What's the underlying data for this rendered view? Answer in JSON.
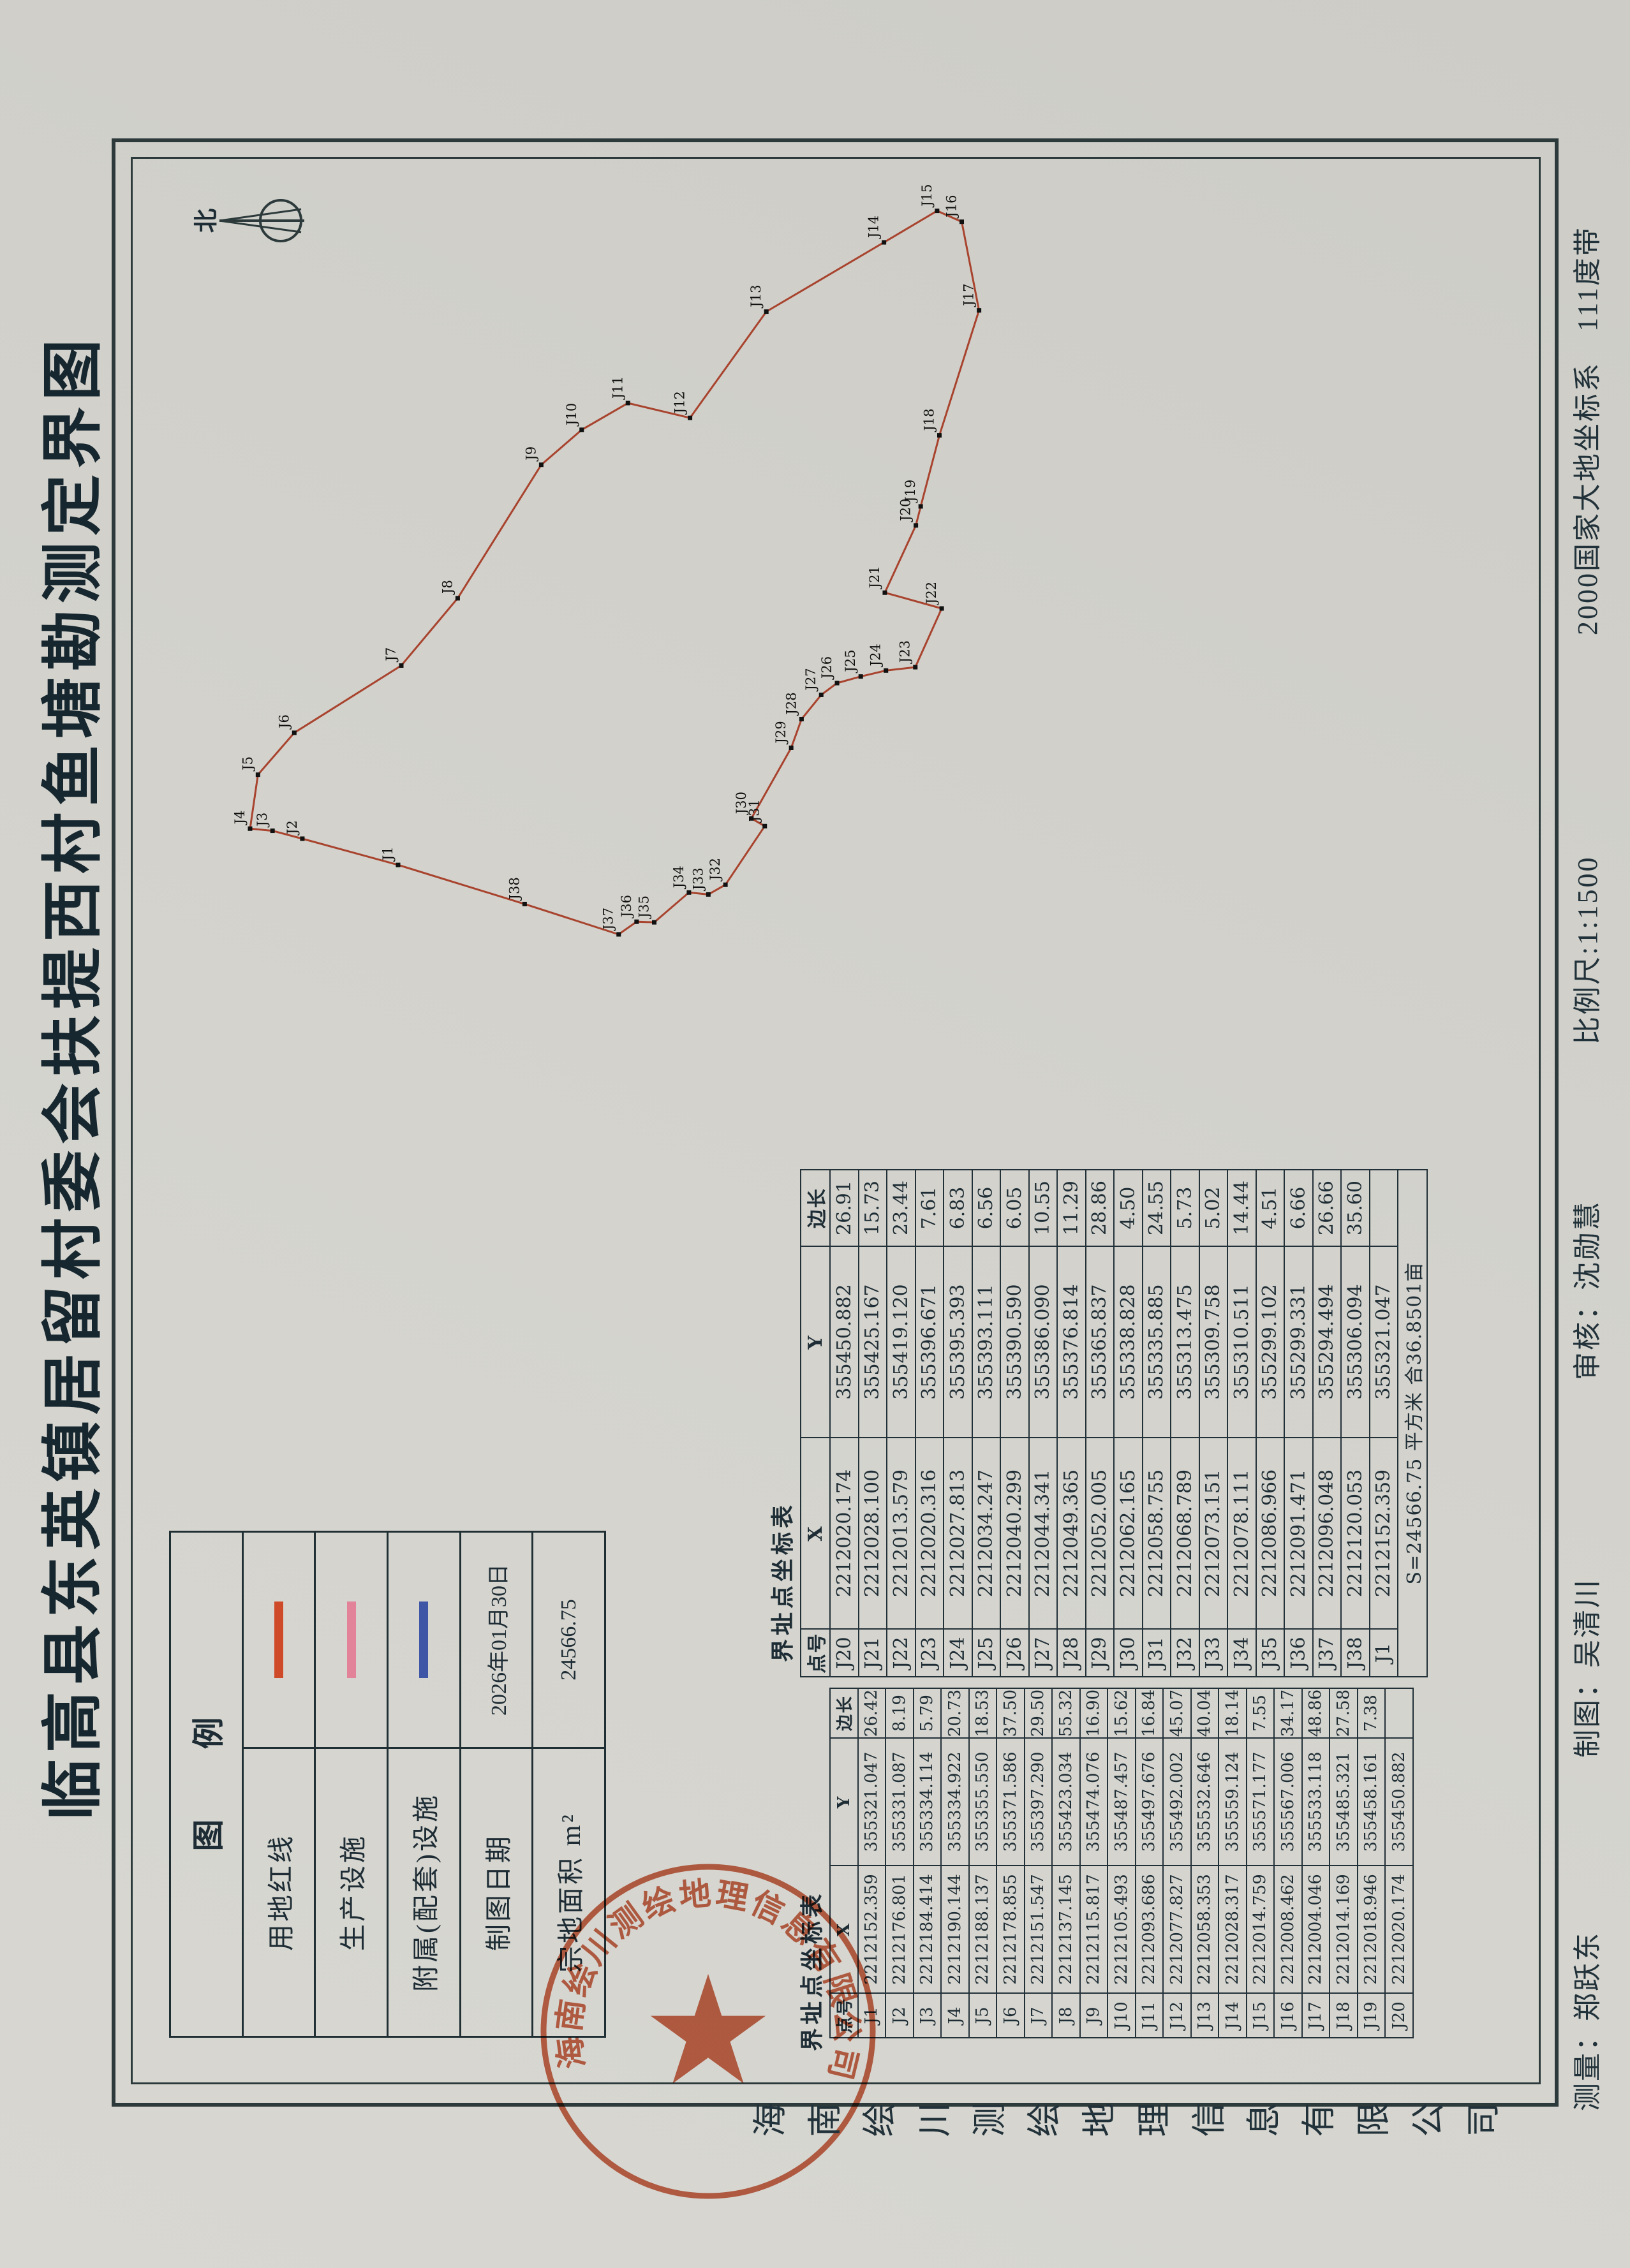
{
  "title": "临高县东英镇居留村委会扶提西村鱼塘勘测定界图",
  "compass": {
    "north": "北"
  },
  "legend": {
    "header": "图例",
    "rows": [
      {
        "label": "用地红线",
        "type": "line",
        "color": "#cf4a28",
        "value": ""
      },
      {
        "label": "生产设施",
        "type": "line",
        "color": "#e2839a",
        "value": ""
      },
      {
        "label": "附属(配套)设施",
        "type": "line",
        "color": "#3f55a6",
        "value": ""
      },
      {
        "label": "制图日期",
        "type": "text",
        "color": "",
        "value": "2026年01月30日"
      },
      {
        "label": "宗地面积 m²",
        "type": "text",
        "color": "",
        "value": "24566.75"
      }
    ]
  },
  "tables": {
    "title": "界址点坐标表",
    "columns": [
      "点号",
      "X",
      "Y",
      "边长"
    ],
    "t1": [
      [
        "J1",
        "2212152.359",
        "355321.047",
        "26.42"
      ],
      [
        "J2",
        "2212176.801",
        "355331.087",
        "8.19"
      ],
      [
        "J3",
        "2212184.414",
        "355334.114",
        "5.79"
      ],
      [
        "J4",
        "2212190.144",
        "355334.922",
        "20.73"
      ],
      [
        "J5",
        "2212188.137",
        "355355.550",
        "18.53"
      ],
      [
        "J6",
        "2212178.855",
        "355371.586",
        "37.50"
      ],
      [
        "J7",
        "2212151.547",
        "355397.290",
        "29.50"
      ],
      [
        "J8",
        "2212137.145",
        "355423.034",
        "55.32"
      ],
      [
        "J9",
        "2212115.817",
        "355474.076",
        "16.90"
      ],
      [
        "J10",
        "2212105.493",
        "355487.457",
        "15.62"
      ],
      [
        "J11",
        "2212093.686",
        "355497.676",
        "16.84"
      ],
      [
        "J12",
        "2212077.827",
        "355492.002",
        "45.07"
      ],
      [
        "J13",
        "2212058.353",
        "355532.646",
        "40.04"
      ],
      [
        "J14",
        "2212028.317",
        "355559.124",
        "18.14"
      ],
      [
        "J15",
        "2212014.759",
        "355571.177",
        "7.55"
      ],
      [
        "J16",
        "2212008.462",
        "355567.006",
        "34.17"
      ],
      [
        "J17",
        "2212004.046",
        "355533.118",
        "48.86"
      ],
      [
        "J18",
        "2212014.169",
        "355485.321",
        "27.58"
      ],
      [
        "J19",
        "2212018.946",
        "355458.161",
        "7.38"
      ],
      [
        "J20",
        "2212020.174",
        "355450.882",
        ""
      ]
    ],
    "t2": [
      [
        "J20",
        "2212020.174",
        "355450.882",
        "26.91"
      ],
      [
        "J21",
        "2212028.100",
        "355425.167",
        "15.73"
      ],
      [
        "J22",
        "2212013.579",
        "355419.120",
        "23.44"
      ],
      [
        "J23",
        "2212020.316",
        "355396.671",
        "7.61"
      ],
      [
        "J24",
        "2212027.813",
        "355395.393",
        "6.83"
      ],
      [
        "J25",
        "2212034.247",
        "355393.111",
        "6.56"
      ],
      [
        "J26",
        "2212040.299",
        "355390.590",
        "6.05"
      ],
      [
        "J27",
        "2212044.341",
        "355386.090",
        "10.55"
      ],
      [
        "J28",
        "2212049.365",
        "355376.814",
        "11.29"
      ],
      [
        "J29",
        "2212052.005",
        "355365.837",
        "28.86"
      ],
      [
        "J30",
        "2212062.165",
        "355338.828",
        "4.50"
      ],
      [
        "J31",
        "2212058.755",
        "355335.885",
        "24.55"
      ],
      [
        "J32",
        "2212068.789",
        "355313.475",
        "5.73"
      ],
      [
        "J33",
        "2212073.151",
        "355309.758",
        "5.02"
      ],
      [
        "J34",
        "2212078.111",
        "355310.511",
        "14.44"
      ],
      [
        "J35",
        "2212086.966",
        "355299.102",
        "4.51"
      ],
      [
        "J36",
        "2212091.471",
        "355299.331",
        "6.66"
      ],
      [
        "J37",
        "2212096.048",
        "355294.494",
        "26.66"
      ],
      [
        "J38",
        "2212120.053",
        "355306.094",
        "35.60"
      ],
      [
        "J1",
        "2212152.359",
        "355321.047",
        ""
      ]
    ],
    "t2_footer": "S=24566.75 平方米 合36.8501亩"
  },
  "map": {
    "boundary_color": "#a8432e",
    "vertex_color": "#111111"
  },
  "stamp": {
    "text": "海南绘川测绘地理信息有限公司",
    "color": "#c75535"
  },
  "margin": {
    "company": "海南绘川测绘地理信息有限公司",
    "credits": [
      "测量：郑跃东",
      "制图：吴清川",
      "审核：沈勋慧",
      "比例尺:1:1500",
      "2000国家大地坐标系　111度带"
    ]
  }
}
